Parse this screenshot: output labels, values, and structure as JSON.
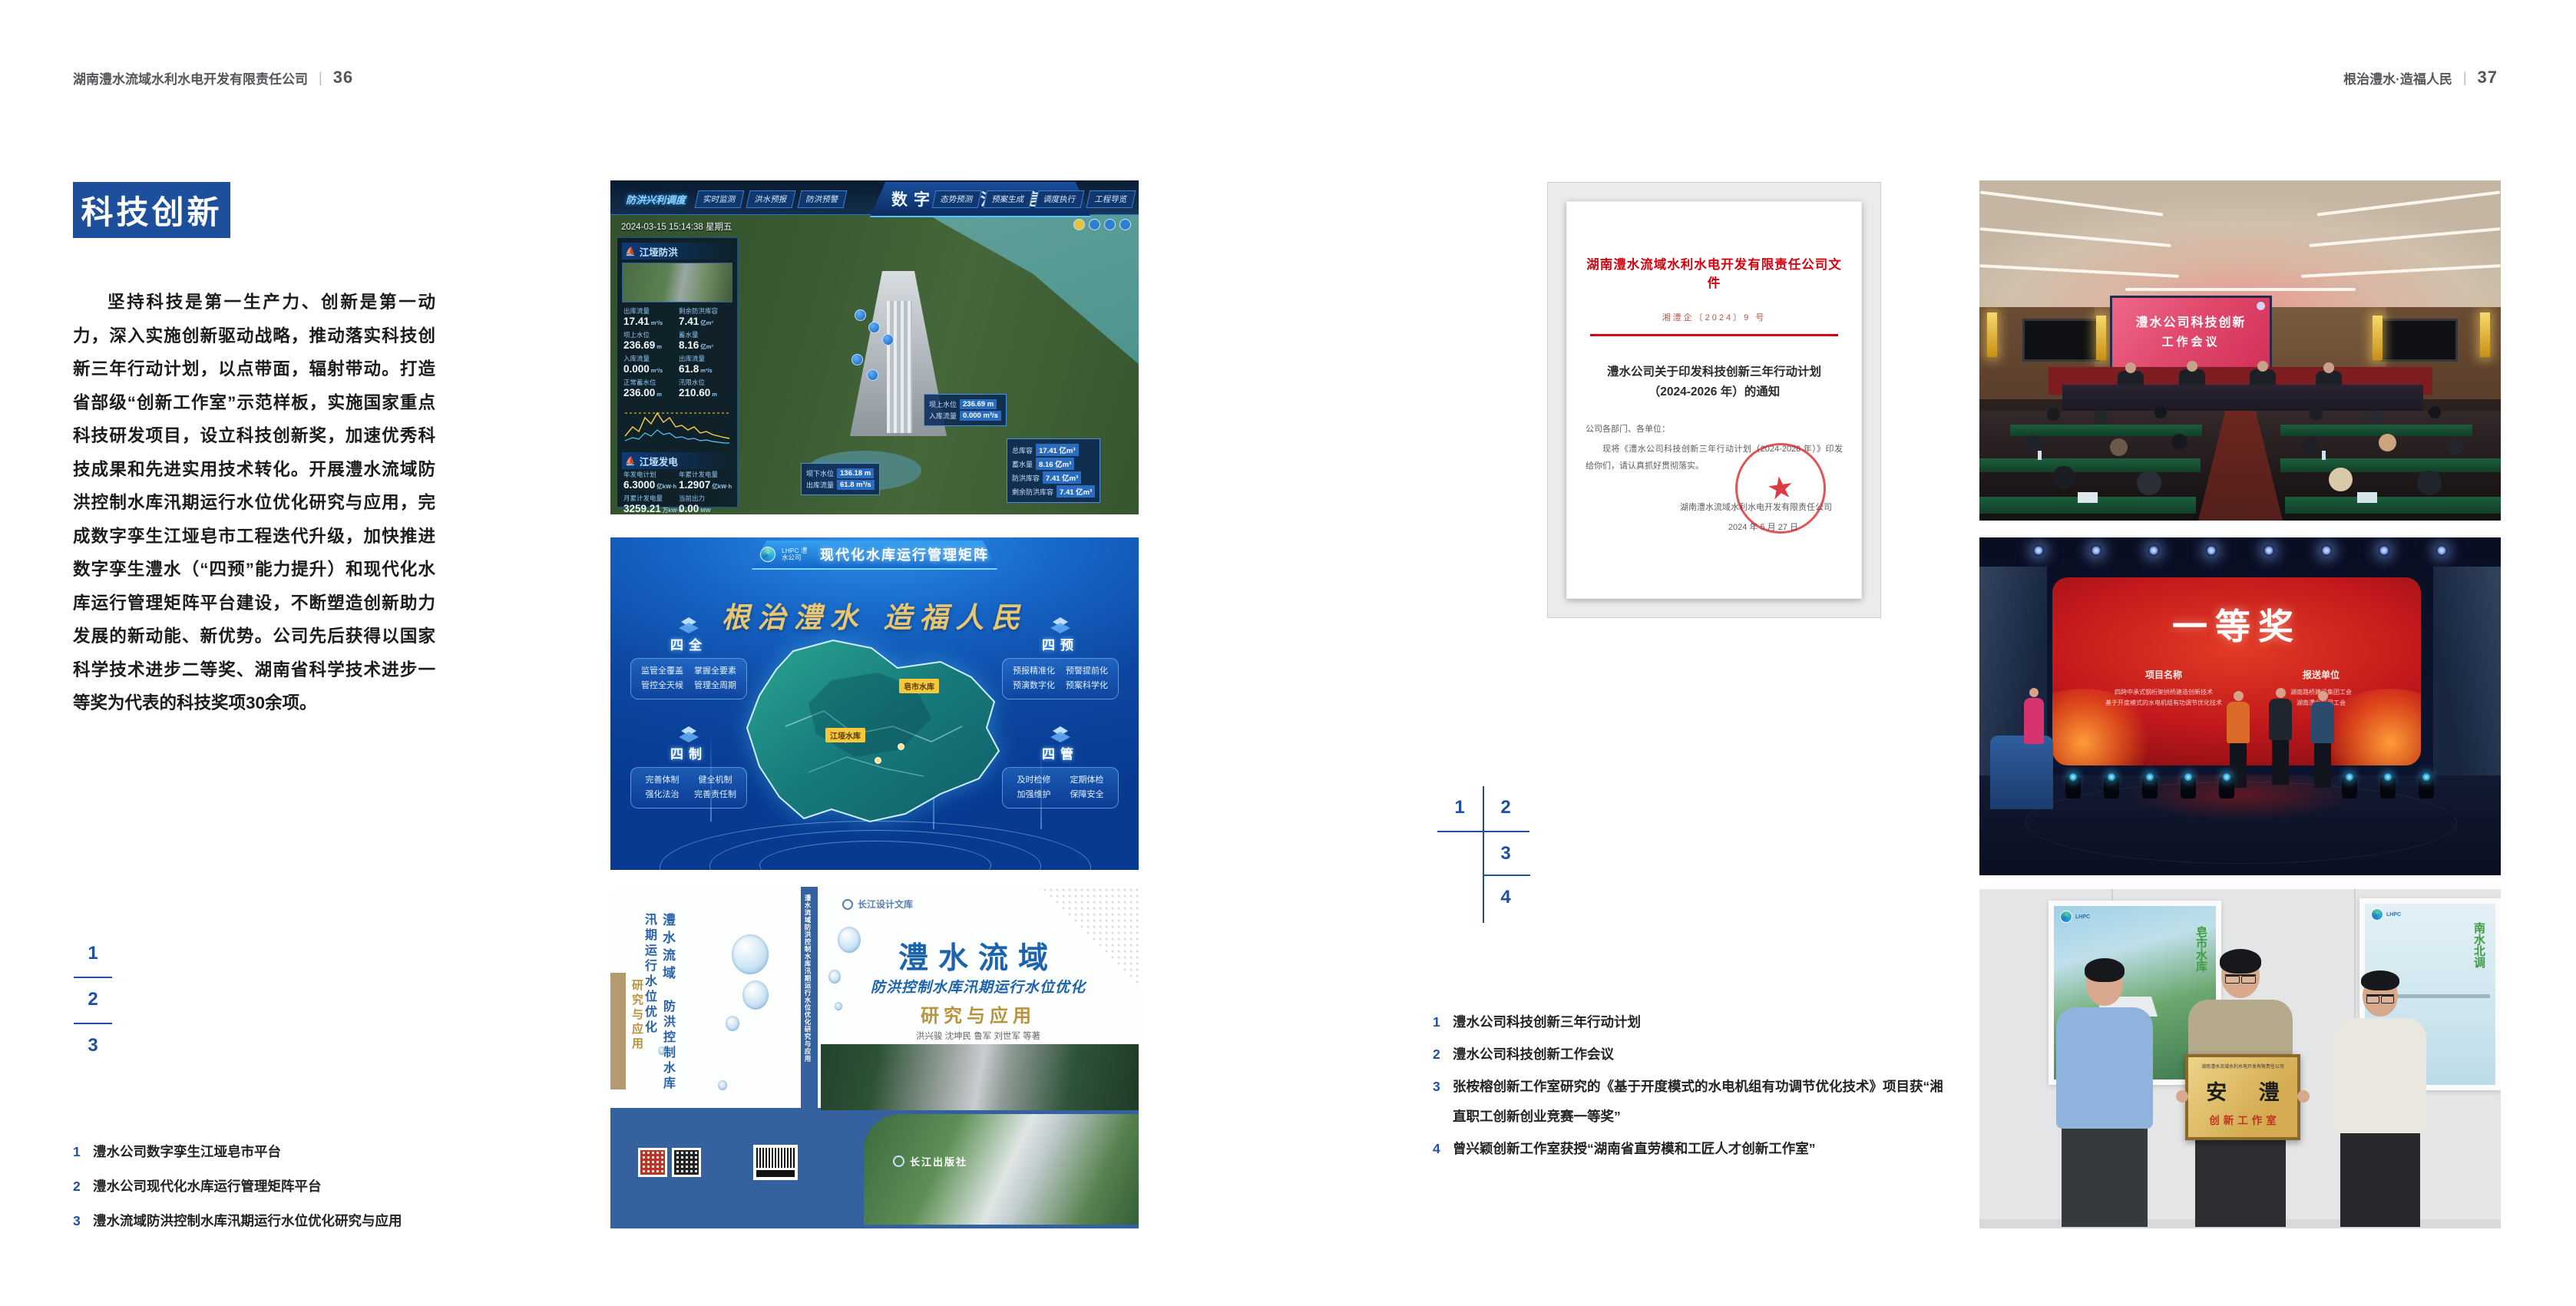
{
  "page_headers": {
    "left": {
      "company": "湖南澧水流域水利水电开发有限责任公司",
      "divider": "|",
      "page_no": "36"
    },
    "right": {
      "slogan": "根治澧水·造福人民",
      "divider": "|",
      "page_no": "37"
    }
  },
  "colors": {
    "accent_blue": "#1d4f9c",
    "doc_red": "#d7000f",
    "gold": "#e9c771"
  },
  "left_page": {
    "badge": "科技创新",
    "paragraph": "坚持科技是第一生产力、创新是第一动力，深入实施创新驱动战略，推动落实科技创新三年行动计划，以点带面，辐射带动。打造省部级“创新工作室”示范样板，实施国家重点科技研发项目，设立科技创新奖，加速优秀科技成果和先进实用技术转化。开展澧水流域防洪控制水库汛期运行水位优化研究与应用，完成数字孪生江垭皂市工程迭代升级，加快推进数字孪生澧水（“四预”能力提升）和现代化水库运行管理矩阵平台建设，不断塑造创新助力发展的新动能、新优势。公司先后获得以国家科学技术进步二等奖、湖南省科学技术进步一等奖为代表的科技奖项30余项。",
    "figure_index": {
      "n1": "1",
      "n2": "2",
      "n3": "3"
    },
    "captions": [
      {
        "num": "1",
        "text": "澧水公司数字孪生江垭皂市平台"
      },
      {
        "num": "2",
        "text": "澧水公司现代化水库运行管理矩阵平台"
      },
      {
        "num": "3",
        "text": "澧水流域防洪控制水库汛期运行水位优化研究与应用"
      }
    ]
  },
  "right_page": {
    "figure_index": {
      "n1": "1",
      "n2": "2",
      "n3": "3",
      "n4": "4"
    },
    "captions": [
      {
        "num": "1",
        "text": "澧水公司科技创新三年行动计划"
      },
      {
        "num": "2",
        "text": "澧水公司科技创新工作会议"
      },
      {
        "num": "3",
        "text": "张桉榕创新工作室研究的《基于开度模式的水电机组有功调节优化技术》项目获“湘直职工创新创业竞赛一等奖”"
      },
      {
        "num": "4",
        "text": "曾兴颖创新工作室获授“湖南省直劳模和工匠人才创新工作室”"
      }
    ]
  },
  "dashboard": {
    "title": "数字孪生江垭皂市",
    "mode_label": "防洪兴利调度",
    "tabs_left": [
      "实时监测",
      "洪水预报",
      "防洪预警"
    ],
    "tabs_right": [
      "态势预测",
      "预案生成",
      "调度执行",
      "工程导览"
    ],
    "datetime": "2024-03-15 15:14:38 星期五",
    "panel_flood": {
      "title": "江垭防洪",
      "metrics": [
        {
          "label": "出库流量",
          "value": "17.41",
          "unit": "m³/s"
        },
        {
          "label": "剩余防洪库容",
          "value": "7.41",
          "unit": "亿m³"
        },
        {
          "label": "坝上水位",
          "value": "236.69",
          "unit": "m"
        },
        {
          "label": "蓄水量",
          "value": "8.16",
          "unit": "亿m³"
        },
        {
          "label": "入库流量",
          "value": "0.000",
          "unit": "m³/s"
        },
        {
          "label": "出库流量",
          "value": "61.8",
          "unit": "m³/s"
        },
        {
          "label": "正常蓄水位",
          "value": "236.00",
          "unit": "m"
        },
        {
          "label": "汛限水位",
          "value": "210.60",
          "unit": "m"
        }
      ]
    },
    "panel_power": {
      "title": "江垭发电",
      "metrics": [
        {
          "label": "年发电计划",
          "value": "6.3000",
          "unit": "亿kW·h"
        },
        {
          "label": "年累计发电量",
          "value": "1.2907",
          "unit": "亿kW·h"
        },
        {
          "label": "月累计发电量",
          "value": "3259.21",
          "unit": "万kW·h"
        },
        {
          "label": "当前出力",
          "value": "0.00",
          "unit": "MW"
        }
      ]
    },
    "tooltip_up": {
      "rows": [
        {
          "label": "坝上水位",
          "value": "236.69 m"
        },
        {
          "label": "入库流量",
          "value": "0.000 m³/s"
        }
      ]
    },
    "tooltip_cap": {
      "rows": [
        {
          "label": "总库容",
          "value": "17.41 亿m³"
        },
        {
          "label": "蓄水量",
          "value": "8.16 亿m³"
        },
        {
          "label": "防洪库容",
          "value": "7.41 亿m³"
        },
        {
          "label": "剩余防洪库容",
          "value": "7.41 亿m³"
        }
      ]
    },
    "tooltip_down": {
      "rows": [
        {
          "label": "坝下水位",
          "value": "136.18 m"
        },
        {
          "label": "出库流量",
          "value": "61.8 m³/s"
        }
      ]
    }
  },
  "matrix": {
    "brand": "LHPC 澧水公司",
    "title": "现代化水库运行管理矩阵",
    "slogan": "根治澧水 造福人民",
    "tags": {
      "zaoshi": "皂市水库",
      "jiangya": "江垭水库"
    },
    "panels": [
      {
        "title": "四全",
        "items": [
          "监管全覆盖",
          "掌握全要素",
          "管控全天候",
          "管理全周期"
        ]
      },
      {
        "title": "四制",
        "items": [
          "完善体制",
          "健全机制",
          "强化法治",
          "完善责任制"
        ]
      },
      {
        "title": "四预",
        "items": [
          "预报精准化",
          "预警提前化",
          "预演数字化",
          "预案科学化"
        ]
      },
      {
        "title": "四管",
        "items": [
          "及时检修",
          "定期体检",
          "加强维护",
          "保障安全"
        ]
      }
    ]
  },
  "book": {
    "series": "长江设计文库",
    "title_main": "澧水流域",
    "title_sub": "防洪控制水库汛期运行水位优化",
    "title_tail": "研究与应用",
    "authors": "洪兴骏 沈坤民 鲁军 刘世军 等著",
    "spine_text": "澧水流域防洪控制水库汛期运行水位优化研究与应用",
    "publisher": "长江出版社",
    "back_title_1": "澧水流域",
    "back_title_2": "防洪控制水库汛期运行水位优化",
    "back_title_tail": "研究与应用"
  },
  "document": {
    "header": "湖南澧水流域水利水电开发有限责任公司文件",
    "doc_no": "湘澧企〔2024〕9 号",
    "title_line1": "澧水公司关于印发科技创新三年行动计划",
    "title_line2": "（2024-2026 年）的通知",
    "salutation": "公司各部门、各单位：",
    "body": "现将《澧水公司科技创新三年行动计划（2024-2026 年）》印发给你们，请认真抓好贯彻落实。",
    "signer": "湖南澧水流域水利水电开发有限责任公司",
    "date": "2024 年 5 月 27 日",
    "seal_star": "★"
  },
  "meeting": {
    "screen_line1": "澧水公司科技创新",
    "screen_line2": "工作会议"
  },
  "stage": {
    "award": "一等奖",
    "col1_header": "项目名称",
    "col1_lines": [
      "四跨中承式钢桁架拱桥建造创新技术",
      "基于开度模式的水电机组有功调节优化技术"
    ],
    "col2_header": "报送单位",
    "col2_lines": [
      "湖南路桥建设集团工会",
      "湖南澧水公司工会"
    ]
  },
  "plaque": {
    "poster_left_text": "皂市水库",
    "poster_right_text": "南水北调",
    "brand": "LHPC",
    "plaque_header": "湖南澧水流域水利水电开发有限责任公司",
    "plaque_name": "安 澧",
    "plaque_sub": "创新工作室"
  }
}
